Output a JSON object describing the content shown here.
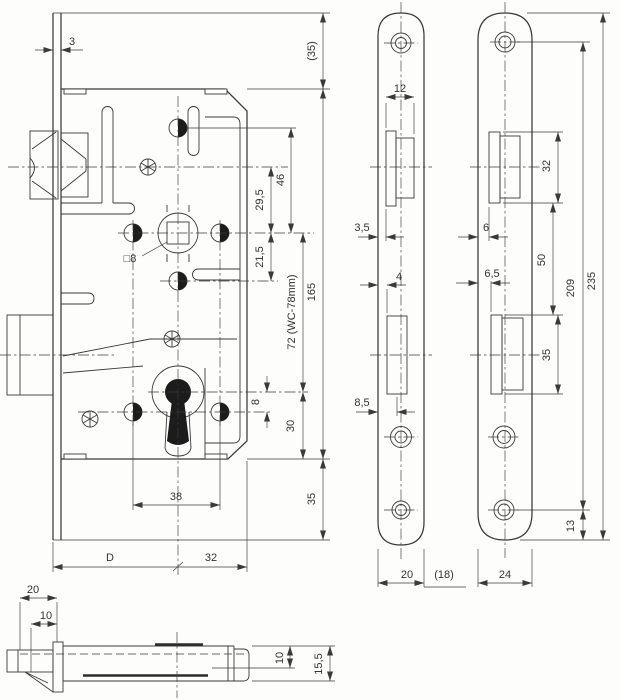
{
  "drawing_type": "mortise-lock technical drawing",
  "colors": {
    "line": "#3a3a3a",
    "background": "#fdfdfc",
    "fill": "#1c1c1c"
  },
  "views": {
    "front": {
      "dims": {
        "plate_thickness": "3",
        "top_overhang": "(35)",
        "top_hole_to_follower": "46",
        "latch_axis_to_follower": "29,5",
        "follower_to_guide_hole": "21,5",
        "follower_to_keyhole": "72 (WC-78mm)",
        "case_height": "165",
        "follower_square": "□8",
        "keyhole_to_hole_row": "8",
        "keyhole_to_case_bottom": "30",
        "bottom_overhang": "35",
        "screw_hole_spacing": "38",
        "backset": "D",
        "follower_to_case_back": "32"
      }
    },
    "faceplate": {
      "dims": {
        "latch_cutout_width": "12",
        "latch_cutout_offset": "3,5",
        "bolt_cutout_offset": "4",
        "bolt_cutout_width": "8,5",
        "plate_width": "20",
        "plate_width_alt": "(18)"
      }
    },
    "strike": {
      "dims": {
        "latch_opening_height": "32",
        "latch_lip_offset": "6",
        "bolt_lip_offset": "6,5",
        "opening_spacing": "50",
        "bolt_opening_height": "35",
        "screw_hole_spacing": "209",
        "plate_height": "235",
        "screw_to_bottom": "13",
        "plate_width": "24"
      }
    },
    "top": {
      "dims": {
        "latch_head_depth": "20",
        "latch_bevel_depth": "10",
        "case_inner_depth": "10",
        "case_outer_depth": "15,5"
      }
    }
  }
}
